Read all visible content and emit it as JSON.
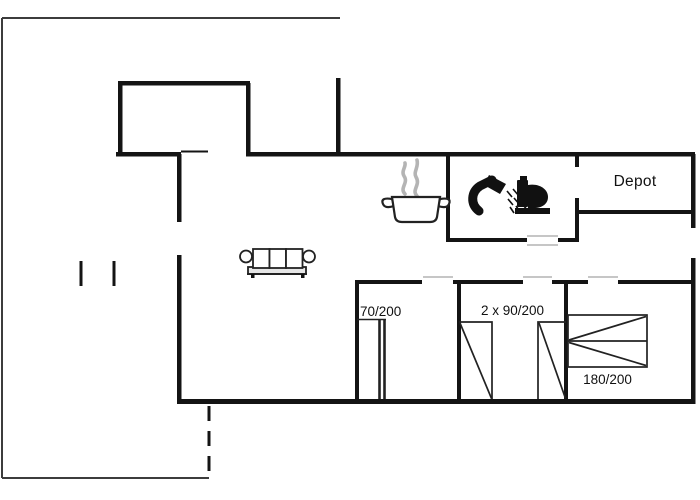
{
  "floorplan": {
    "labels": {
      "depot": "Depot",
      "bed_single": "70/200",
      "bed_twin": "2 x 90/200",
      "bed_double": "180/200"
    },
    "icons": {
      "cooking_pot": "cooking-pot-with-steam-icon",
      "shower": "shower-head-spray-icon",
      "toilet": "toilet-icon",
      "sofa": "three-seat-sofa-icon"
    },
    "colors": {
      "wall": "#141414",
      "line": "#222222",
      "thin_line": "#3c3c3c",
      "door_marker": "#c6c6c6",
      "steam": "#b4b4b4",
      "icon": "#111111",
      "background": "#ffffff"
    }
  }
}
